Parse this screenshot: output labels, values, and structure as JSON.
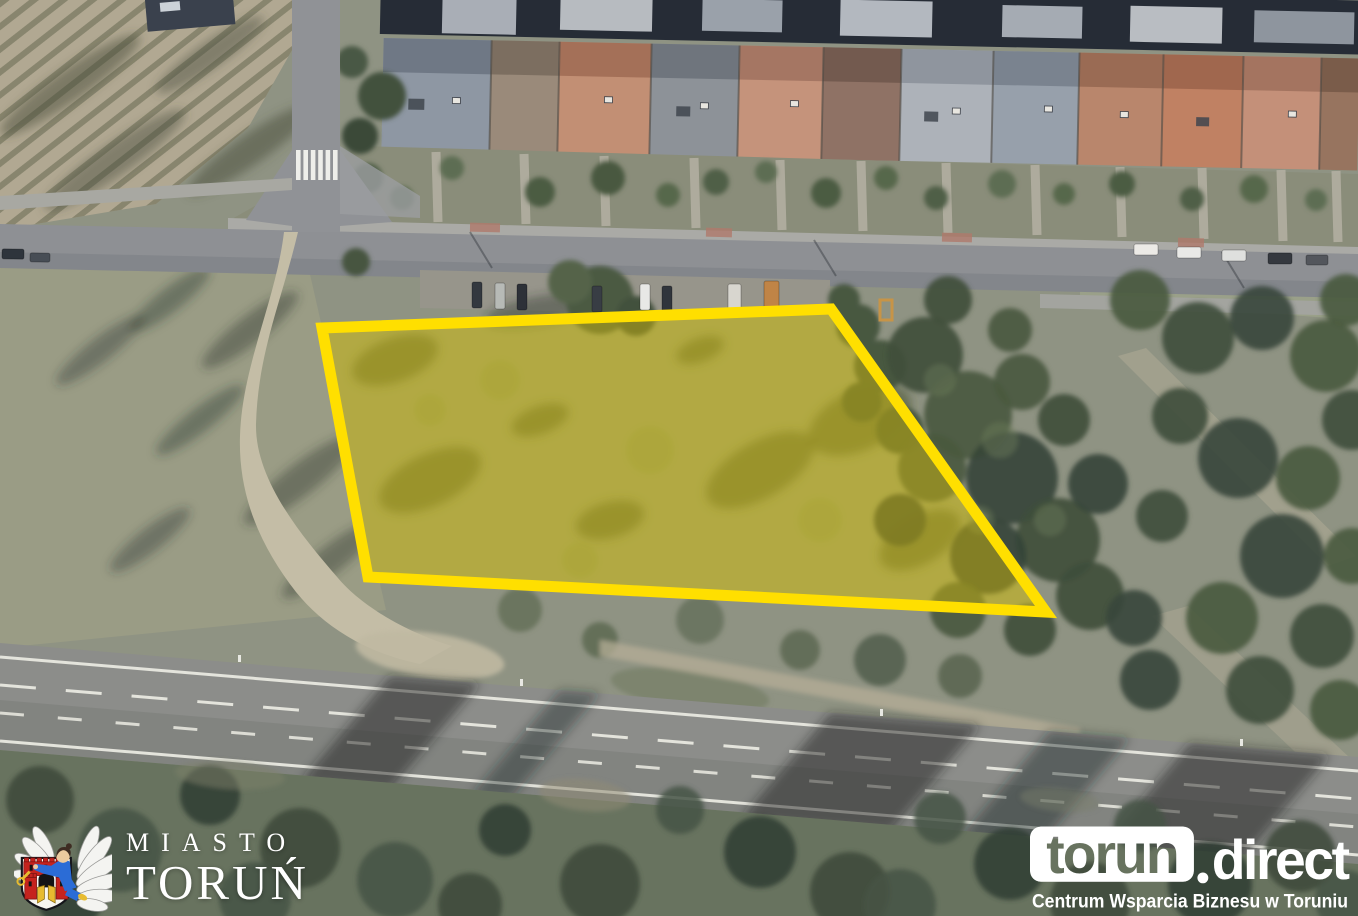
{
  "branding": {
    "city_logo": {
      "line1": "MIASTO",
      "line2": "TORUŃ",
      "crest_icon": "torun-coat-of-arms"
    },
    "torun_direct": {
      "box_text": "torun",
      "suffix": "direct",
      "tagline": "Centrum Wsparcia Biznesu w Toruniu"
    }
  },
  "map": {
    "type": "aerial-photo",
    "parcel_highlight": {
      "points_str": "322,328 831,309 1046,612 368,577",
      "stroke": "#ffdf00",
      "fill": "rgba(236,205,0,0.40)"
    }
  },
  "colors": {
    "parcel_border": "#ffdf00",
    "parcel_fill": "rgba(236,205,0,0.40)",
    "road_gray": "#8c8d8a",
    "terrain_green": "#8f9383",
    "tree_dark": "#42513d",
    "logo_text": "#ffffff"
  }
}
